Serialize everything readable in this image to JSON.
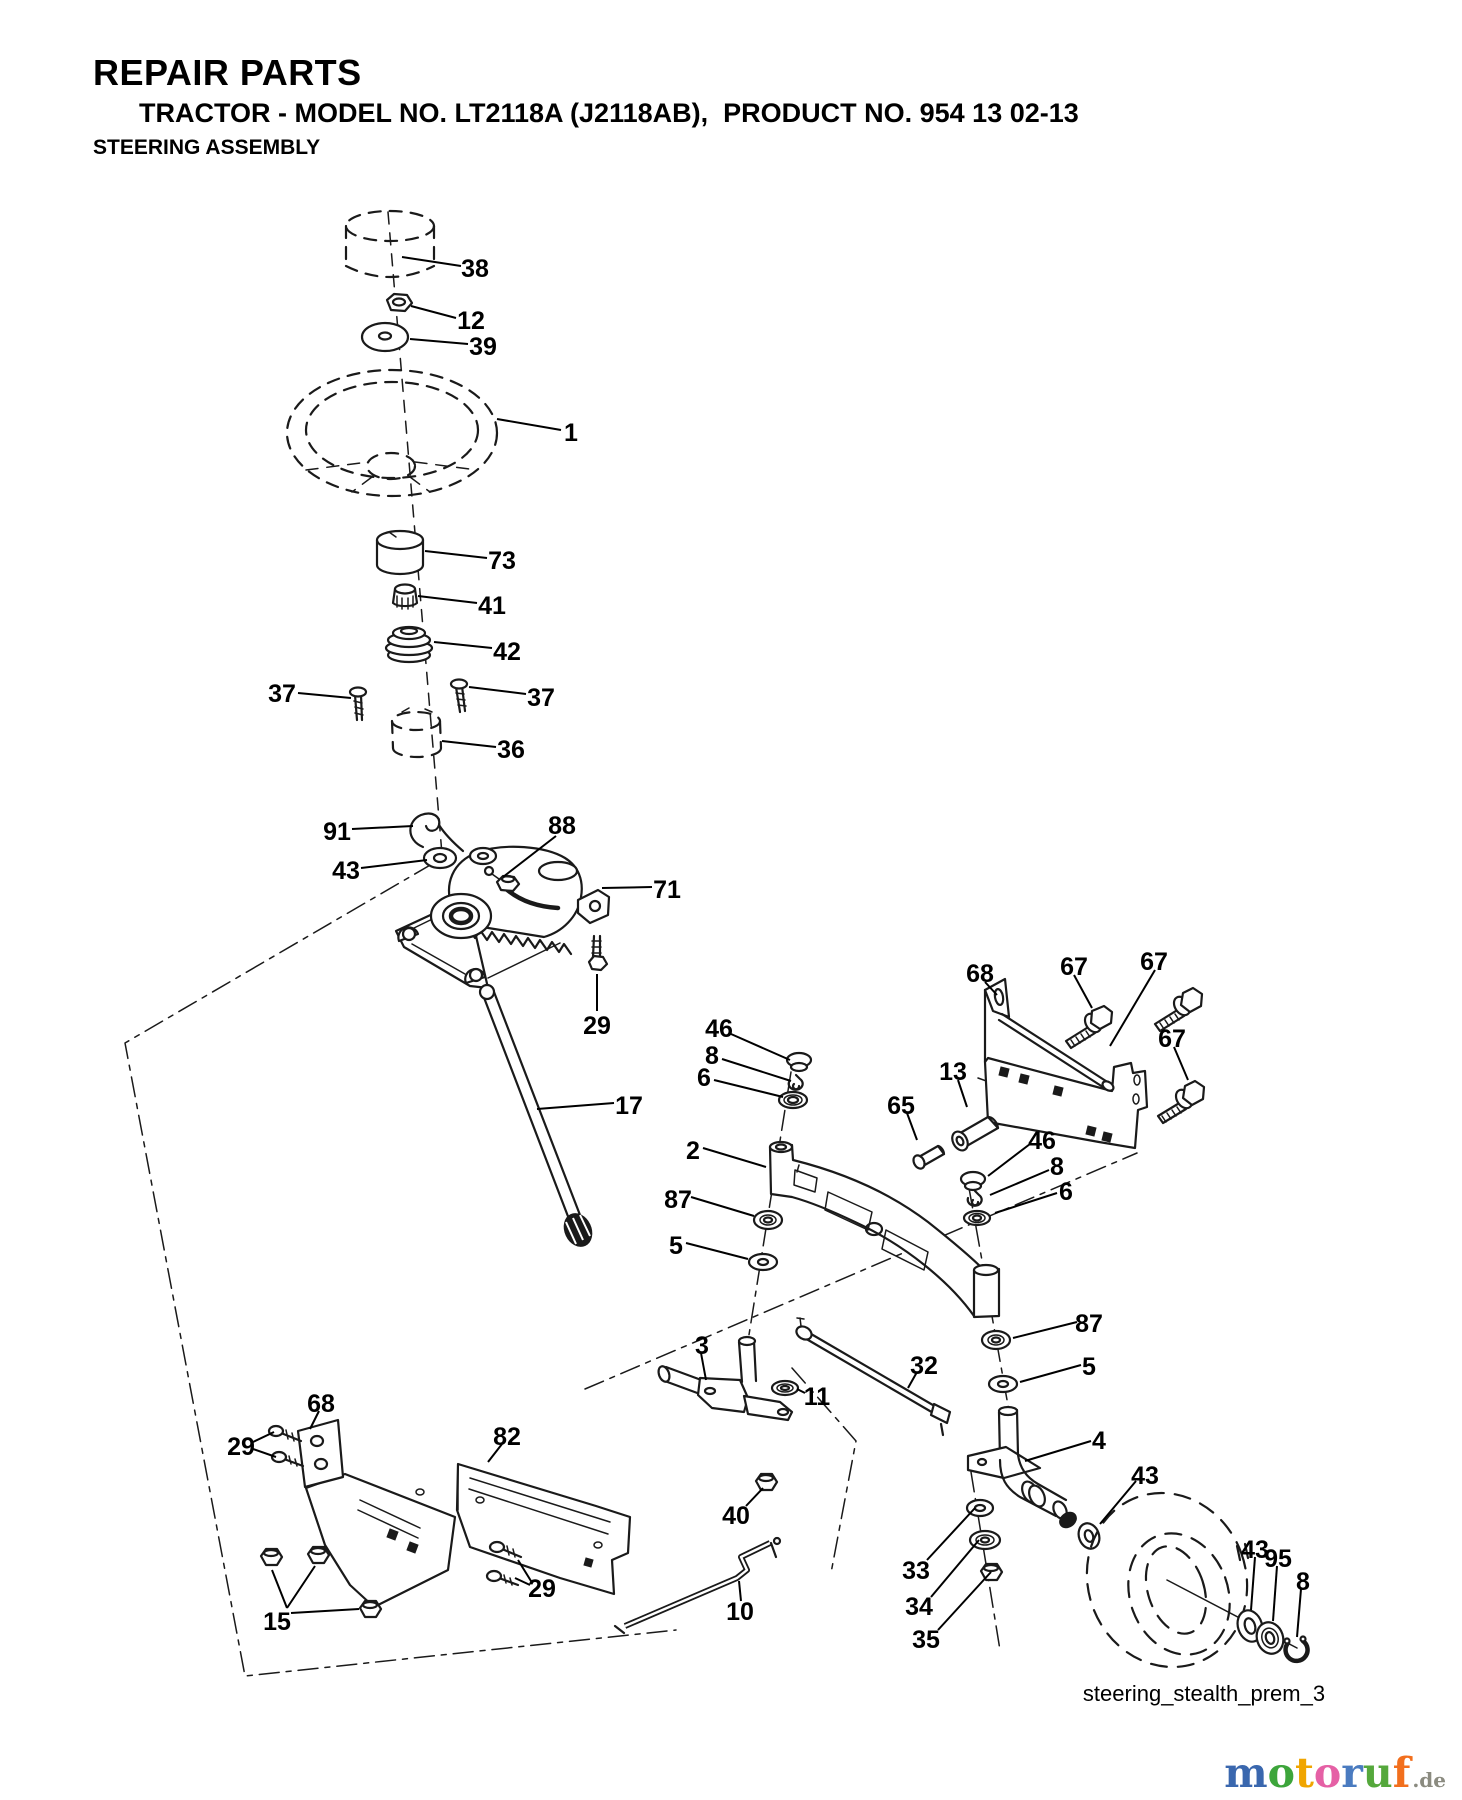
{
  "header": {
    "title": "REPAIR PARTS",
    "subtitle": "TRACTOR - MODEL NO. LT2118A (J2118AB),  PRODUCT NO. 954 13 02-13",
    "section": "STEERING ASSEMBLY"
  },
  "diagram": {
    "caption": "steering_stealth_prem_3",
    "callouts": [
      {
        "n": "38",
        "x": 475,
        "y": 268,
        "lines": [
          [
            461,
            266,
            402,
            257
          ]
        ]
      },
      {
        "n": "12",
        "x": 471,
        "y": 320,
        "lines": [
          [
            456,
            318,
            411,
            306
          ]
        ]
      },
      {
        "n": "39",
        "x": 483,
        "y": 346,
        "lines": [
          [
            468,
            344,
            410,
            339
          ]
        ]
      },
      {
        "n": "1",
        "x": 571,
        "y": 432,
        "lines": [
          [
            561,
            430,
            497,
            419
          ]
        ]
      },
      {
        "n": "73",
        "x": 502,
        "y": 560,
        "lines": [
          [
            487,
            558,
            425,
            551
          ]
        ]
      },
      {
        "n": "41",
        "x": 492,
        "y": 605,
        "lines": [
          [
            477,
            603,
            418,
            596
          ]
        ]
      },
      {
        "n": "42",
        "x": 507,
        "y": 651,
        "lines": [
          [
            492,
            648,
            434,
            642
          ]
        ]
      },
      {
        "n": "37",
        "x": 282,
        "y": 693,
        "lines": [
          [
            298,
            693,
            351,
            698
          ]
        ]
      },
      {
        "n": "37",
        "x": 541,
        "y": 697,
        "lines": [
          [
            526,
            694,
            469,
            687
          ]
        ]
      },
      {
        "n": "36",
        "x": 511,
        "y": 749,
        "lines": [
          [
            496,
            747,
            442,
            741
          ]
        ]
      },
      {
        "n": "91",
        "x": 337,
        "y": 831,
        "lines": [
          [
            352,
            829,
            413,
            826
          ]
        ]
      },
      {
        "n": "43",
        "x": 346,
        "y": 870,
        "lines": [
          [
            361,
            868,
            427,
            860
          ]
        ]
      },
      {
        "n": "88",
        "x": 562,
        "y": 825,
        "lines": [
          [
            556,
            836,
            503,
            877
          ]
        ]
      },
      {
        "n": "71",
        "x": 667,
        "y": 889,
        "lines": [
          [
            652,
            887,
            602,
            888
          ]
        ]
      },
      {
        "n": "29",
        "x": 597,
        "y": 1025,
        "lines": [
          [
            597,
            1011,
            597,
            974
          ]
        ]
      },
      {
        "n": "17",
        "x": 629,
        "y": 1105,
        "lines": [
          [
            614,
            1103,
            537,
            1109
          ]
        ]
      },
      {
        "n": "46",
        "x": 719,
        "y": 1028,
        "lines": [
          [
            731,
            1034,
            790,
            1060
          ]
        ]
      },
      {
        "n": "8",
        "x": 712,
        "y": 1055,
        "lines": [
          [
            722,
            1059,
            791,
            1081
          ]
        ]
      },
      {
        "n": "6",
        "x": 704,
        "y": 1077,
        "lines": [
          [
            714,
            1080,
            783,
            1097
          ]
        ]
      },
      {
        "n": "2",
        "x": 693,
        "y": 1150,
        "lines": [
          [
            703,
            1148,
            766,
            1167
          ]
        ]
      },
      {
        "n": "87",
        "x": 678,
        "y": 1199,
        "lines": [
          [
            691,
            1197,
            754,
            1216
          ]
        ]
      },
      {
        "n": "5",
        "x": 676,
        "y": 1245,
        "lines": [
          [
            686,
            1243,
            748,
            1259
          ]
        ]
      },
      {
        "n": "68",
        "x": 980,
        "y": 973,
        "lines": [
          [
            985,
            982,
            997,
            995
          ]
        ]
      },
      {
        "n": "67",
        "x": 1074,
        "y": 966,
        "lines": [
          [
            1074,
            975,
            1092,
            1008
          ]
        ]
      },
      {
        "n": "67",
        "x": 1154,
        "y": 961,
        "lines": [
          [
            1155,
            970,
            1110,
            1046
          ]
        ]
      },
      {
        "n": "67",
        "x": 1172,
        "y": 1038,
        "lines": [
          [
            1174,
            1047,
            1188,
            1080
          ]
        ]
      },
      {
        "n": "13",
        "x": 953,
        "y": 1071,
        "lines": [
          [
            958,
            1080,
            967,
            1107
          ]
        ]
      },
      {
        "n": "65",
        "x": 901,
        "y": 1105,
        "lines": [
          [
            907,
            1113,
            917,
            1140
          ]
        ]
      },
      {
        "n": "46",
        "x": 1042,
        "y": 1140,
        "lines": [
          [
            1030,
            1144,
            988,
            1176
          ]
        ]
      },
      {
        "n": "8",
        "x": 1057,
        "y": 1166,
        "lines": [
          [
            1049,
            1170,
            990,
            1195
          ]
        ]
      },
      {
        "n": "6",
        "x": 1066,
        "y": 1191,
        "lines": [
          [
            1057,
            1193,
            995,
            1213
          ]
        ]
      },
      {
        "n": "87",
        "x": 1089,
        "y": 1323,
        "lines": [
          [
            1077,
            1322,
            1013,
            1338
          ]
        ]
      },
      {
        "n": "5",
        "x": 1089,
        "y": 1366,
        "lines": [
          [
            1081,
            1365,
            1020,
            1382
          ]
        ]
      },
      {
        "n": "3",
        "x": 702,
        "y": 1345,
        "lines": [
          [
            701,
            1353,
            706,
            1380
          ]
        ]
      },
      {
        "n": "11",
        "x": 817,
        "y": 1396,
        "lines": [
          [
            805,
            1393,
            797,
            1389
          ]
        ]
      },
      {
        "n": "32",
        "x": 924,
        "y": 1365,
        "lines": [
          [
            917,
            1372,
            908,
            1388
          ]
        ]
      },
      {
        "n": "40",
        "x": 736,
        "y": 1515,
        "lines": [
          [
            746,
            1506,
            763,
            1488
          ]
        ]
      },
      {
        "n": "10",
        "x": 740,
        "y": 1611,
        "lines": [
          [
            741,
            1601,
            739,
            1581
          ]
        ]
      },
      {
        "n": "68",
        "x": 321,
        "y": 1403,
        "lines": [
          [
            319,
            1411,
            310,
            1429
          ]
        ]
      },
      {
        "n": "29",
        "x": 241,
        "y": 1446,
        "lines": [
          [
            253,
            1442,
            274,
            1432
          ],
          [
            253,
            1449,
            276,
            1457
          ]
        ]
      },
      {
        "n": "82",
        "x": 507,
        "y": 1436,
        "lines": [
          [
            502,
            1444,
            488,
            1462
          ]
        ]
      },
      {
        "n": "29",
        "x": 542,
        "y": 1588,
        "lines": [
          [
            531,
            1581,
            518,
            1560
          ],
          [
            530,
            1585,
            515,
            1578
          ]
        ]
      },
      {
        "n": "15",
        "x": 277,
        "y": 1621,
        "lines": [
          [
            287,
            1608,
            272,
            1570
          ],
          [
            287,
            1608,
            315,
            1566
          ],
          [
            291,
            1613,
            359,
            1609
          ]
        ]
      },
      {
        "n": "33",
        "x": 916,
        "y": 1570,
        "lines": [
          [
            927,
            1560,
            975,
            1508
          ]
        ]
      },
      {
        "n": "34",
        "x": 919,
        "y": 1606,
        "lines": [
          [
            931,
            1597,
            979,
            1540
          ]
        ]
      },
      {
        "n": "35",
        "x": 926,
        "y": 1639,
        "lines": [
          [
            938,
            1630,
            991,
            1572
          ]
        ]
      },
      {
        "n": "4",
        "x": 1099,
        "y": 1440,
        "lines": [
          [
            1091,
            1441,
            1025,
            1461
          ]
        ]
      },
      {
        "n": "43",
        "x": 1145,
        "y": 1475,
        "lines": [
          [
            1136,
            1481,
            1100,
            1524
          ]
        ]
      },
      {
        "n": "43",
        "x": 1255,
        "y": 1549,
        "lines": [
          [
            1255,
            1557,
            1251,
            1610
          ]
        ]
      },
      {
        "n": "95",
        "x": 1278,
        "y": 1558,
        "lines": [
          [
            1277,
            1566,
            1273,
            1621
          ]
        ]
      },
      {
        "n": "8",
        "x": 1303,
        "y": 1581,
        "lines": [
          [
            1301,
            1589,
            1297,
            1637
          ]
        ]
      }
    ]
  },
  "watermark": {
    "word": [
      {
        "ch": "m",
        "color": "#3a67ae"
      },
      {
        "ch": "o",
        "color": "#3da53b"
      },
      {
        "ch": "t",
        "color": "#f0a500"
      },
      {
        "ch": "o",
        "color": "#e560a5"
      },
      {
        "ch": "r",
        "color": "#4a7bc0"
      },
      {
        "ch": "u",
        "color": "#55a83c"
      },
      {
        "ch": "f",
        "color": "#f26f1d"
      }
    ],
    "suffix": ".de",
    "suffix_color": "#8b8b80"
  }
}
